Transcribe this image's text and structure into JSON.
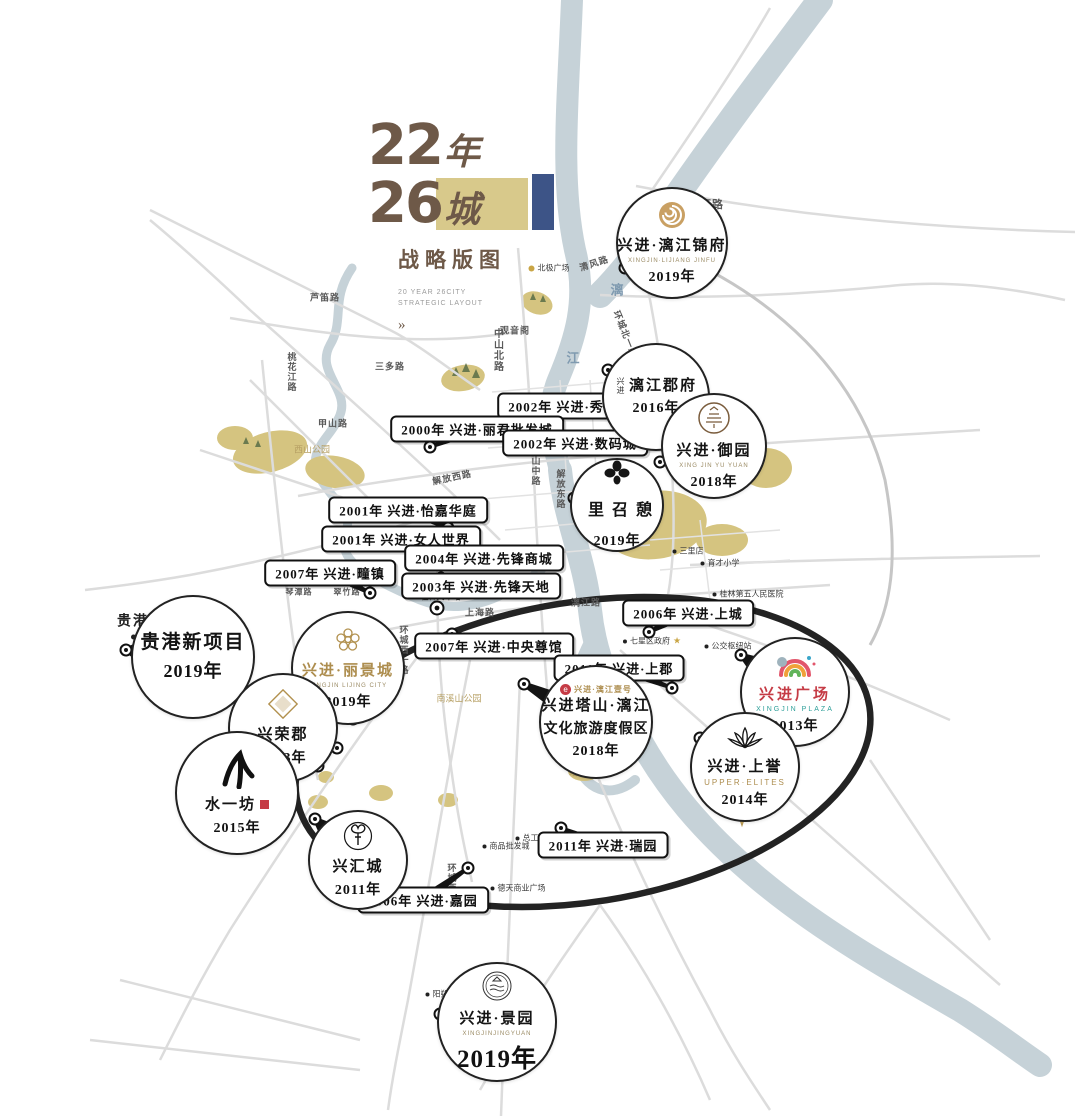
{
  "title": {
    "num1": "22",
    "unit1": "年",
    "num2": "26",
    "unit2": "城",
    "subtitle": "战略版图",
    "en1": "20 YEAR 26CITY",
    "en2": "STRATEGIC LAYOUT",
    "more": "»"
  },
  "colors": {
    "brown": "#6e5948",
    "gold": "#d8c98b",
    "navy": "#3d5487",
    "river": "#c6d2d8",
    "road": "#dcdcdc",
    "park": "#d5c480",
    "ring": "#232323",
    "gold_text": "#ad8d4e",
    "red": "#c53b45",
    "teal": "#2fa09a"
  },
  "badges": [
    {
      "id": "lijiang-jinfu",
      "logo": "swirl",
      "name": "兴进·漓江锦府",
      "sub": "XINGJIN·LIJIANG JINFU",
      "year": "2019年",
      "cx": 672,
      "cy": 243,
      "r": 56,
      "tx": 625,
      "ty": 268
    },
    {
      "id": "lijiang-junfu",
      "logo": "none",
      "prefix": "兴进",
      "name": "漓江郡府",
      "year": "2016年",
      "cx": 656,
      "cy": 397,
      "r": 54,
      "tx": 608,
      "ty": 370
    },
    {
      "id": "yuyuan",
      "logo": "seal",
      "name": "兴进·御园",
      "sub": "XING JIN YU YUAN",
      "year": "2018年",
      "cx": 714,
      "cy": 446,
      "r": 53,
      "tx": 660,
      "ty": 462
    },
    {
      "id": "qizhaoli",
      "logo": "clover",
      "name": "憩召里",
      "year": "2019年",
      "cx": 617,
      "cy": 505,
      "r": 47,
      "vertical": true,
      "tx": 574,
      "ty": 498
    },
    {
      "id": "guigang-new",
      "logo": "none",
      "name": "贵港新项目",
      "year": "2019年",
      "cx": 193,
      "cy": 657,
      "r": 62,
      "big": true,
      "tx": 126,
      "ty": 650
    },
    {
      "id": "lijingcheng",
      "logo": "flower",
      "name": "兴进·丽景城",
      "sub": "XINGJIN LIJING CITY",
      "year": "2019年",
      "cx": 348,
      "cy": 668,
      "r": 57,
      "name_class": "gold",
      "tx": 353,
      "ty": 719
    },
    {
      "id": "xingrongjun",
      "logo": "diamond",
      "name": "兴荣郡",
      "year": "2013年",
      "cx": 283,
      "cy": 728,
      "r": 55,
      "tx": 337,
      "ty": 748
    },
    {
      "id": "shuiyifang",
      "logo": "brush",
      "name": "水一坊",
      "year": "2015年",
      "cx": 237,
      "cy": 793,
      "r": 62,
      "seal": true,
      "tx": 318,
      "ty": 766
    },
    {
      "id": "xinghuicheng",
      "logo": "tree",
      "name": "兴汇城",
      "year": "2011年",
      "cx": 358,
      "cy": 860,
      "r": 50,
      "tx": 315,
      "ty": 819
    },
    {
      "id": "tashan",
      "logo": "eround",
      "logo_text": "兴进·漓江壹号",
      "name": "兴进塔山·漓江",
      "name2": "文化旅游度假区",
      "year": "2018年",
      "cx": 596,
      "cy": 722,
      "r": 57,
      "tx": 524,
      "ty": 684
    },
    {
      "id": "guangchang",
      "logo": "rainbow",
      "name": "兴进广场",
      "sub": "XINGJIN PLAZA",
      "year": "2013年",
      "cx": 795,
      "cy": 692,
      "r": 55,
      "name_class": "red",
      "sub_class": "teal",
      "tx": 741,
      "ty": 655
    },
    {
      "id": "shangyu",
      "logo": "lotus",
      "name": "兴进·上誉",
      "sub": "UPPER·ELITES",
      "year": "2014年",
      "cx": 745,
      "cy": 767,
      "r": 55,
      "sub_class": "goldsub",
      "tx": 700,
      "ty": 738
    },
    {
      "id": "jingyuan",
      "logo": "emblem",
      "name": "兴进·景园",
      "sub": "XINGJINJINGYUAN",
      "year": "2019年",
      "cx": 497,
      "cy": 1022,
      "r": 60,
      "year_big": true,
      "tx": 440,
      "ty": 1014
    }
  ],
  "labels": [
    {
      "text": "2002年 兴进·秀峰翠苑",
      "x": 577,
      "y": 406,
      "tx": 536,
      "ty": 424
    },
    {
      "text": "2000年 兴进·丽君批发城",
      "x": 477,
      "y": 429,
      "tx": 430,
      "ty": 447
    },
    {
      "text": "2002年 兴进·数码城",
      "x": 575,
      "y": 443,
      "tx": 539,
      "ty": 425
    },
    {
      "text": "2001年 兴进·怡嘉华庭",
      "x": 408,
      "y": 510,
      "tx": 448,
      "ty": 528
    },
    {
      "text": "2001年 兴进·女人世界",
      "x": 401,
      "y": 539,
      "tx": 441,
      "ty": 559
    },
    {
      "text": "2004年 兴进·先锋商城",
      "x": 484,
      "y": 558,
      "tx": 447,
      "ty": 563
    },
    {
      "text": "2003年 兴进·先锋天地",
      "x": 481,
      "y": 586,
      "tx": 441,
      "ty": 578
    },
    {
      "text": "2007年 兴进·疃镇",
      "x": 330,
      "y": 573,
      "tx": 370,
      "ty": 593
    },
    {
      "text": "2006年 兴进·上城",
      "x": 688,
      "y": 613,
      "tx": 649,
      "ty": 632
    },
    {
      "text": "2007年 兴进·中央尊馆",
      "x": 494,
      "y": 646,
      "tx": 452,
      "ty": 634
    },
    {
      "text": "2011年 兴进·上郡",
      "x": 619,
      "y": 668,
      "tx": 672,
      "ty": 688
    },
    {
      "text": "2011年 兴进·瑞园",
      "x": 603,
      "y": 845,
      "tx": 561,
      "ty": 828
    },
    {
      "text": "2006年 兴进·嘉园",
      "x": 423,
      "y": 900,
      "tx": 468,
      "ty": 868
    }
  ],
  "road_labels": [
    {
      "text": "东二环路",
      "x": 700,
      "y": 204,
      "size": 11
    },
    {
      "text": "清风路",
      "x": 594,
      "y": 263,
      "rot": -18,
      "size": 9
    },
    {
      "text": "环城北一路",
      "x": 626,
      "y": 334,
      "rot": 68,
      "size": 9
    },
    {
      "text": "中山北路",
      "x": 497,
      "y": 350,
      "vert": true,
      "size": 10
    },
    {
      "text": "观音阁",
      "x": 515,
      "y": 330,
      "size": 9
    },
    {
      "text": "三多路",
      "x": 390,
      "y": 366,
      "size": 9
    },
    {
      "text": "芦笛路",
      "x": 325,
      "y": 297,
      "size": 9
    },
    {
      "text": "桃花江路",
      "x": 292,
      "y": 372,
      "vert": true,
      "size": 9
    },
    {
      "text": "甲山路",
      "x": 333,
      "y": 423,
      "size": 9
    },
    {
      "text": "解放西路",
      "x": 452,
      "y": 477,
      "rot": -12,
      "size": 9
    },
    {
      "text": "解放东路",
      "x": 561,
      "y": 489,
      "vert": true,
      "size": 9
    },
    {
      "text": "中山中路",
      "x": 536,
      "y": 466,
      "vert": true,
      "size": 9
    },
    {
      "text": "龙隐路",
      "x": 597,
      "y": 531,
      "rot": 15,
      "size": 9
    },
    {
      "text": "琴潭路",
      "x": 299,
      "y": 592,
      "size": 8
    },
    {
      "text": "翠竹路",
      "x": 347,
      "y": 592,
      "size": 8
    },
    {
      "text": "上海路",
      "x": 480,
      "y": 612,
      "size": 9
    },
    {
      "text": "漓江路",
      "x": 586,
      "y": 602,
      "size": 9
    },
    {
      "text": "环城西一路",
      "x": 404,
      "y": 650,
      "vert": true,
      "size": 9
    },
    {
      "text": "环城西二路",
      "x": 452,
      "y": 888,
      "vert": true,
      "size": 9
    }
  ],
  "pois": [
    {
      "text": "北极广场",
      "x": 549,
      "y": 268,
      "dot": "gold"
    },
    {
      "text": "三里店",
      "x": 688,
      "y": 551
    },
    {
      "text": "育才小学",
      "x": 720,
      "y": 563
    },
    {
      "text": "桂林第五人民医院",
      "x": 748,
      "y": 594
    },
    {
      "text": "七星区政府",
      "x": 652,
      "y": 641,
      "star": true
    },
    {
      "text": "公交枢纽站",
      "x": 728,
      "y": 646
    },
    {
      "text": "桂林火车站",
      "x": 437,
      "y": 597,
      "station": true
    },
    {
      "text": "总工会",
      "x": 531,
      "y": 838
    },
    {
      "text": "商品批发城",
      "x": 506,
      "y": 846
    },
    {
      "text": "德天商业广场",
      "x": 518,
      "y": 888
    },
    {
      "text": "阳朔县城",
      "x": 445,
      "y": 994
    },
    {
      "text": "贵港",
      "x": 133,
      "y": 625,
      "big": true
    }
  ],
  "river_labels": [
    {
      "text": "漓",
      "x": 617,
      "y": 289
    },
    {
      "text": "江",
      "x": 573,
      "y": 357
    },
    {
      "text": "江",
      "x": 605,
      "y": 765
    }
  ],
  "park_labels": [
    {
      "text": "西山公园",
      "x": 312,
      "y": 449
    },
    {
      "text": "南溪山公园",
      "x": 459,
      "y": 698
    },
    {
      "text": "塔山",
      "x": 578,
      "y": 772
    }
  ],
  "compass": {
    "label": "N"
  }
}
